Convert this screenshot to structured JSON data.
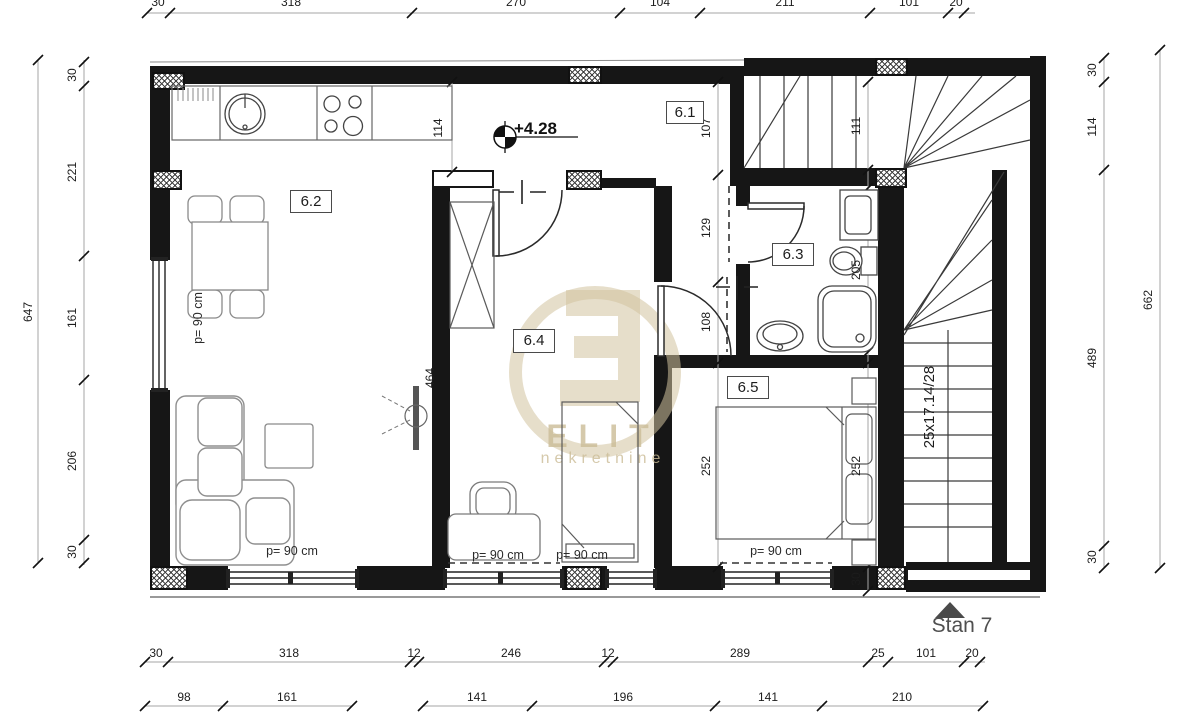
{
  "labels": {
    "level": "+4.28",
    "stair_formula": "25x17.14/28",
    "unit": "Stan 7",
    "parapet": "p= 90 cm"
  },
  "watermark": {
    "brand": "ELIT",
    "subtitle": "nekretnine"
  },
  "rooms": {
    "r61": "6.1",
    "r62": "6.2",
    "r63": "6.3",
    "r64": "6.4",
    "r65": "6.5"
  },
  "dims": {
    "top": [
      "30",
      "318",
      "270",
      "104",
      "211",
      "101",
      "20"
    ],
    "bottom_row1": [
      "30",
      "318",
      "12",
      "246",
      "12",
      "289",
      "25",
      "101",
      "20"
    ],
    "bottom_row2": [
      "98",
      "161",
      "141",
      "196",
      "141",
      "210"
    ],
    "left_total": "647",
    "left_inner": [
      "30",
      "221",
      "161",
      "206",
      "30"
    ],
    "right_inner": [
      "30",
      "114",
      "489",
      "30"
    ],
    "right_total": "662",
    "hall_width": "114",
    "col_mid": [
      "107",
      "129",
      "108",
      "252"
    ],
    "col_right": [
      "111",
      "205",
      "252",
      "30"
    ],
    "room64_depth": "464"
  }
}
